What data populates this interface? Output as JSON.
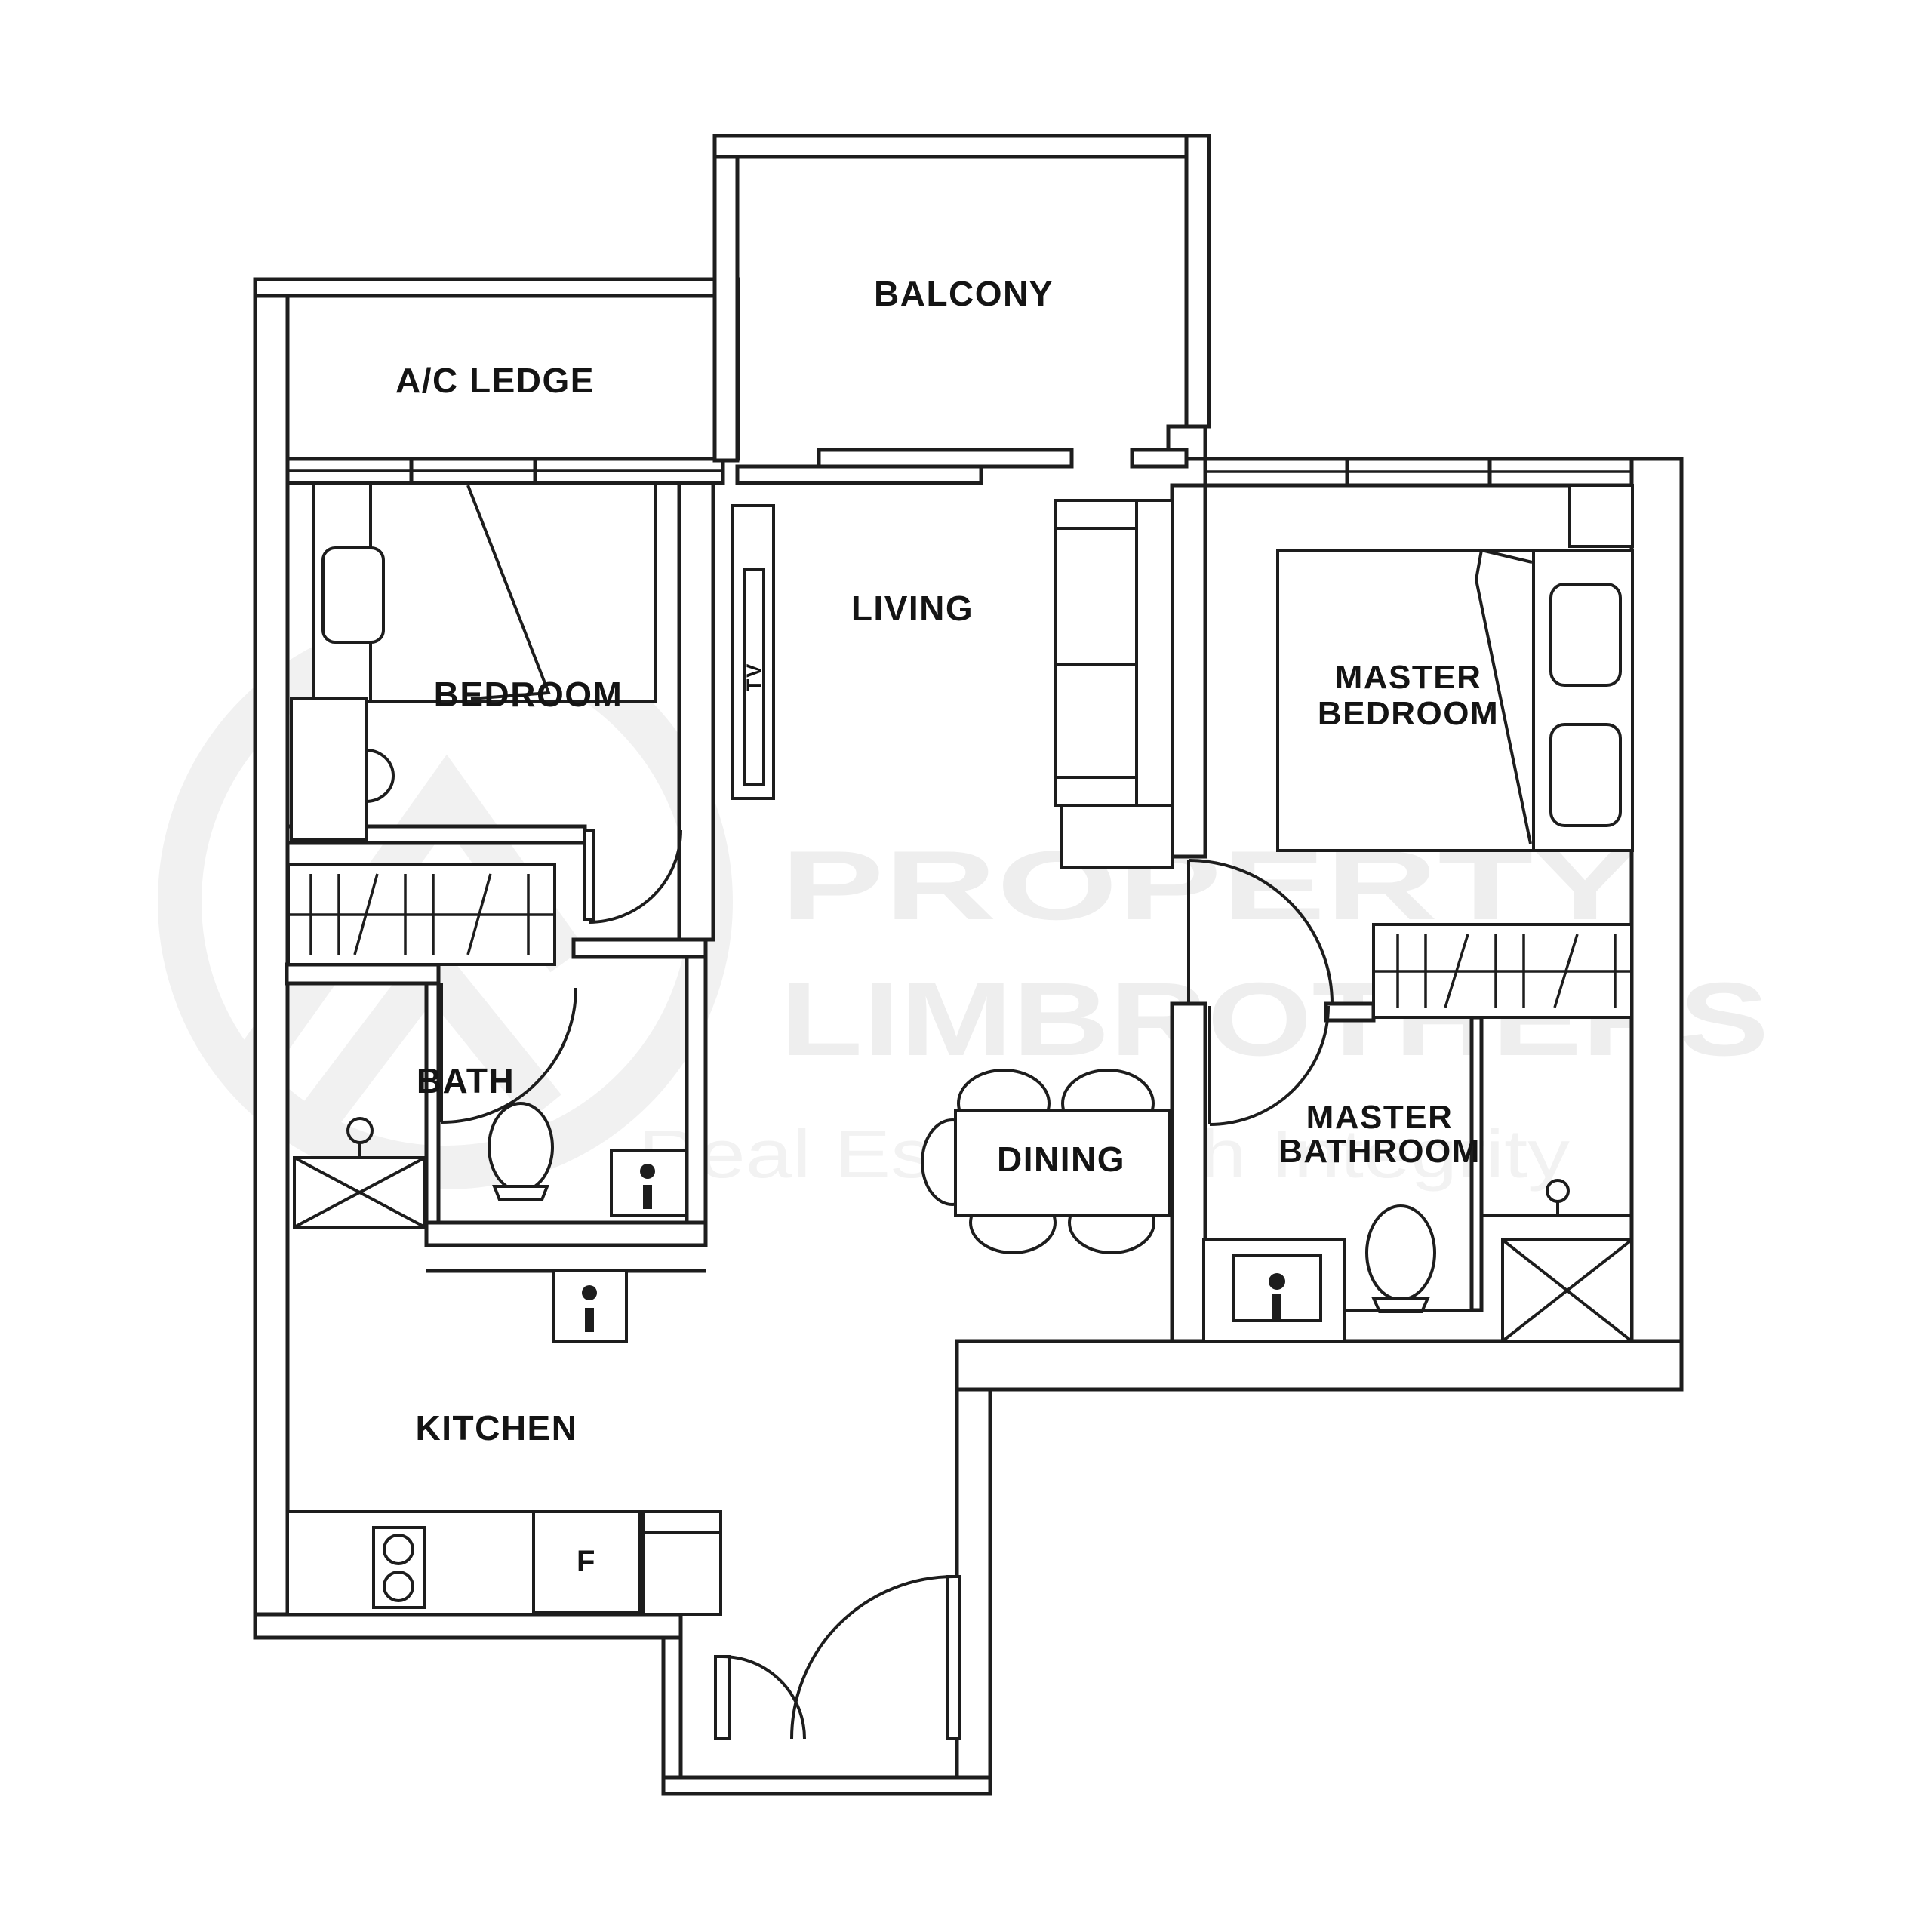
{
  "document": {
    "type": "floor-plan",
    "units_note": "2-bedroom apartment floor plan"
  },
  "colors": {
    "background": "#ffffff",
    "line": "#1d1d1d",
    "watermark": "#eeeeee"
  },
  "watermark": {
    "title": "PROPERTY",
    "brand": "LIMBROTHERS",
    "tagline": "Real Estate with Integrity",
    "logo": "limbrothers-circle-mountain-logo"
  },
  "rooms": {
    "ac_ledge": "A/C LEDGE",
    "balcony": "BALCONY",
    "bedroom": "BEDROOM",
    "living": "LIVING",
    "master_bedroom_line1": "MASTER",
    "master_bedroom_line2": "BEDROOM",
    "bath": "BATH",
    "dining": "DINING",
    "master_bathroom_line1": "MASTER",
    "master_bathroom_line2": "BATHROOM",
    "kitchen": "KITCHEN"
  },
  "appliances": {
    "tv": "TV",
    "fridge": "F"
  }
}
